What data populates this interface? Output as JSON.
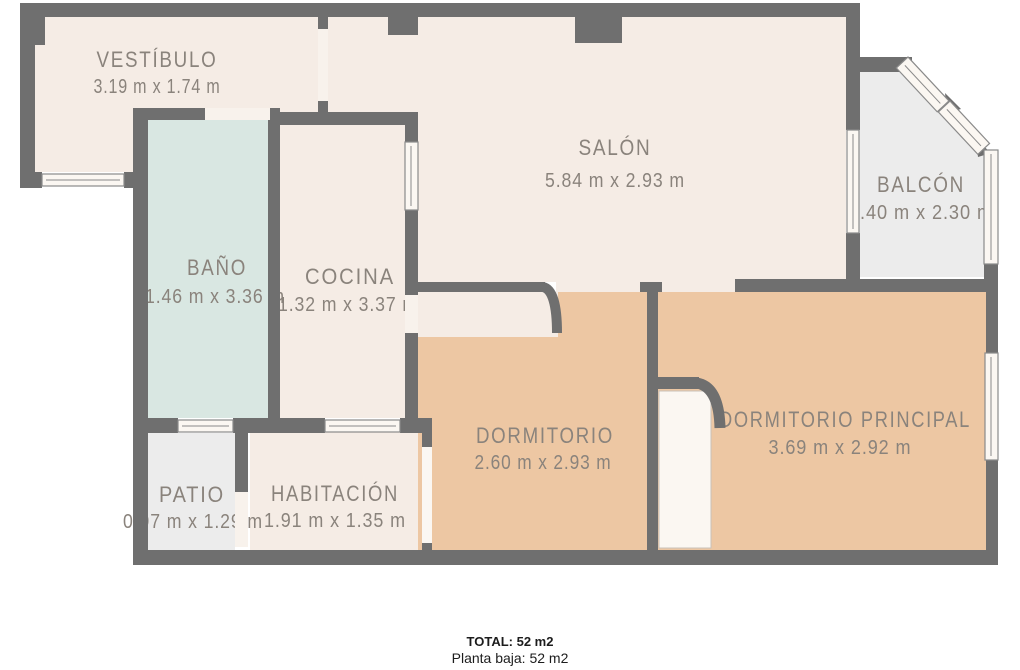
{
  "plan": {
    "type": "floorplan",
    "rooms": [
      {
        "id": "vestibulo",
        "name": "VESTÍBULO",
        "dimensions": "3.19 m x 1.74 m"
      },
      {
        "id": "bano",
        "name": "BAÑO",
        "dimensions": "1.46 m x 3.36 m"
      },
      {
        "id": "cocina",
        "name": "COCINA",
        "dimensions": "1.32 m x 3.37 m"
      },
      {
        "id": "salon",
        "name": "SALÓN",
        "dimensions": "5.84 m x 2.93 m"
      },
      {
        "id": "balcon",
        "name": "BALCÓN",
        "dimensions": "1.40 m x 2.30 m"
      },
      {
        "id": "dormitorio",
        "name": "DORMITORIO",
        "dimensions": "2.60 m x 2.93 m"
      },
      {
        "id": "dormitorio-principal",
        "name": "DORMITORIO PRINCIPAL",
        "dimensions": "3.69 m x 2.92 m"
      },
      {
        "id": "patio",
        "name": "PATIO",
        "dimensions": "0.97 m x 1.29 m"
      },
      {
        "id": "habitacion",
        "name": "HABITACIÓN",
        "dimensions": "1.91 m x 1.35 m"
      }
    ]
  },
  "colors": {
    "wall": "#6f6f6f",
    "floor_cream": "#f5ece5",
    "floor_bath": "#d9e7e2",
    "floor_bedroom": "#edc7a3",
    "floor_gray": "#ececec",
    "window_fill": "#fbf7f2",
    "opening_fill": "#f8f2ec",
    "label_text": "#8a837c"
  },
  "footer": {
    "total": "TOTAL: 52 m2",
    "floor": "Planta baja: 52 m2"
  }
}
